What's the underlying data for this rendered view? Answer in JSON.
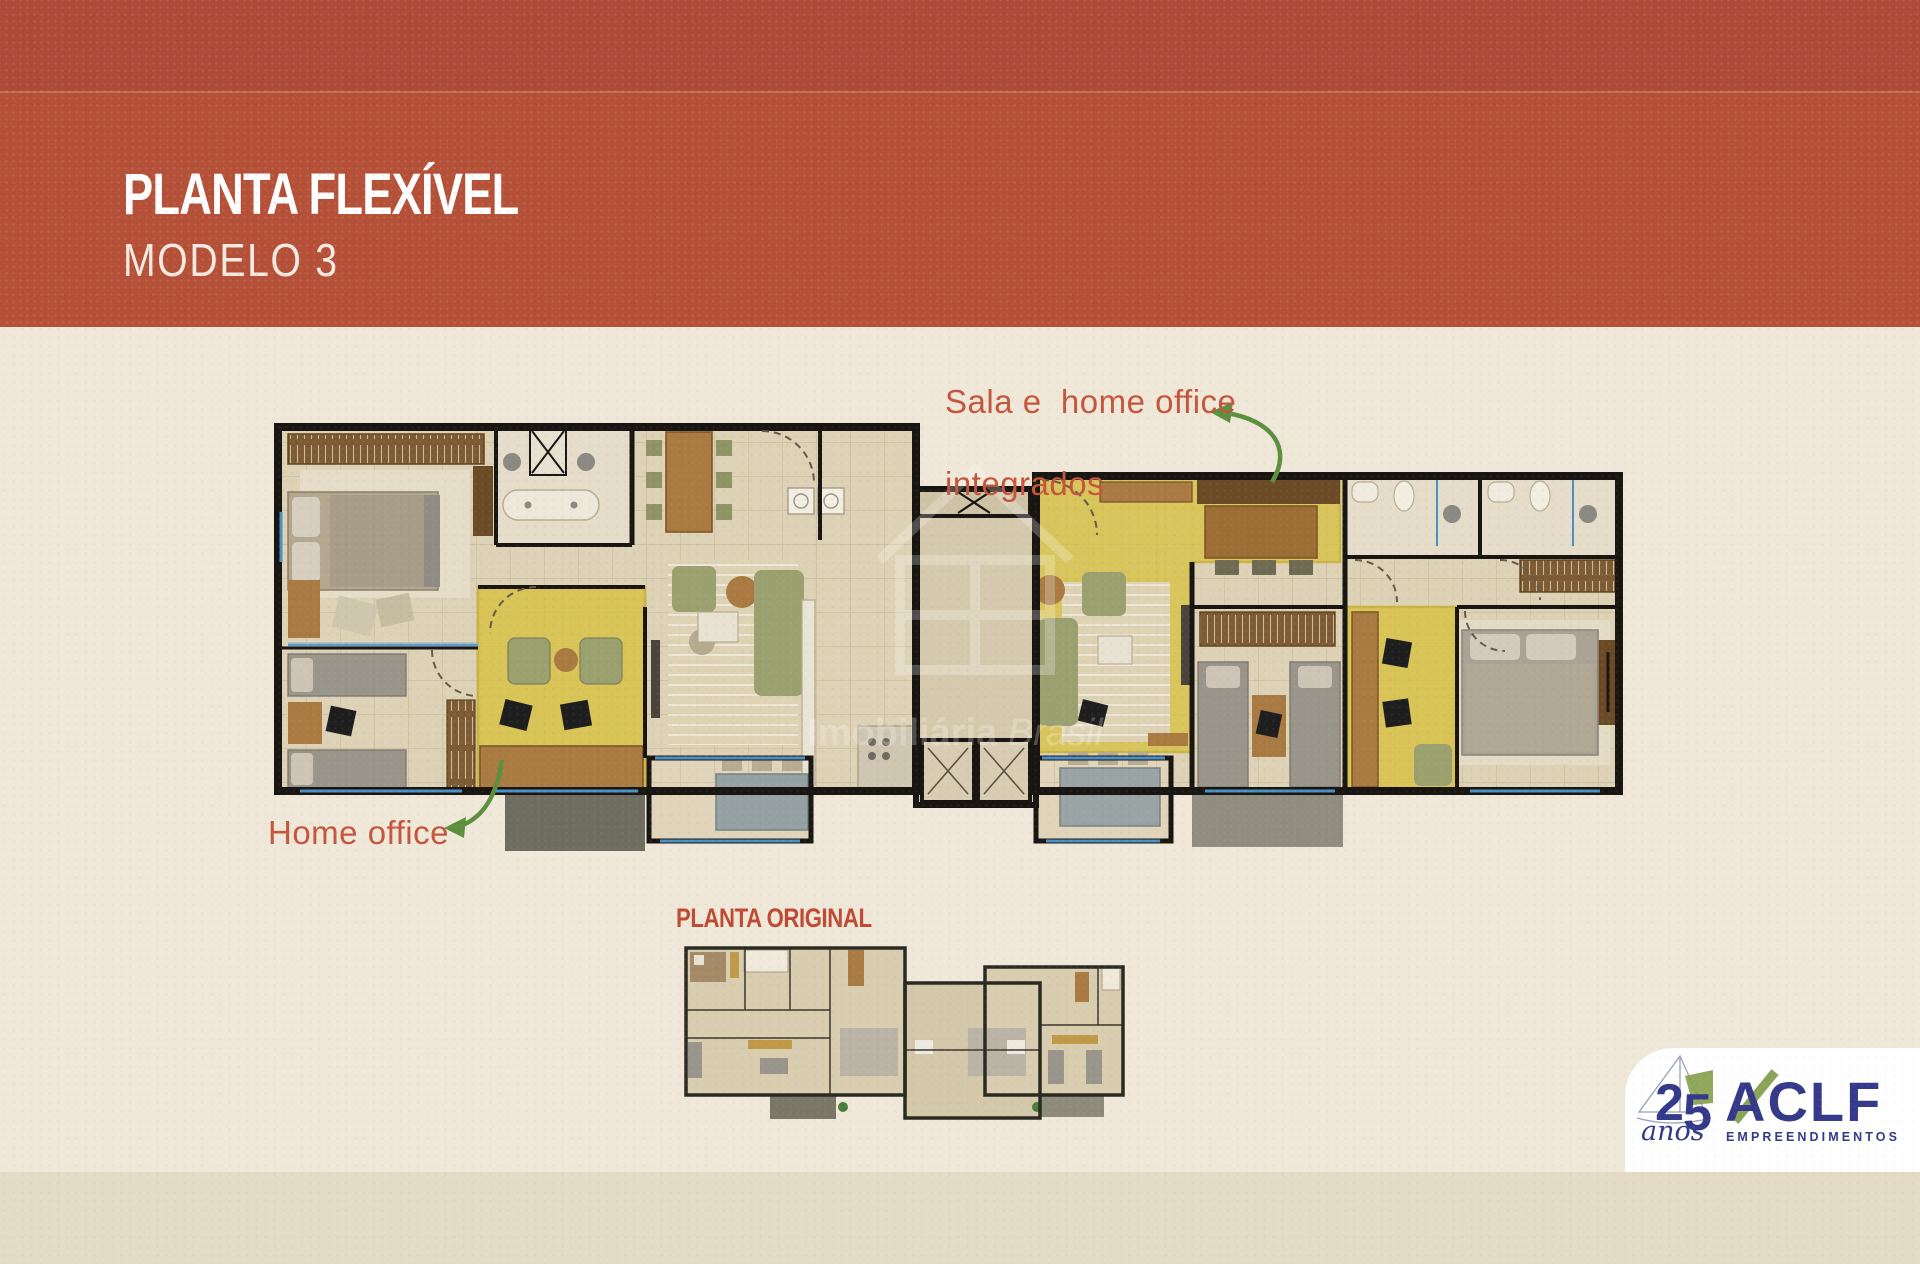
{
  "header": {
    "title": "PLANTA FLEXÍVEL",
    "subtitle": "MODELO 3"
  },
  "annotations": {
    "sala_line1": "Sala e  home office",
    "sala_line2": "integrados",
    "home_office": "Home office"
  },
  "original_plan": {
    "label": "PLANTA ORIGINAL"
  },
  "watermark": {
    "word1": "Imobiliária",
    "word2": " Brasil"
  },
  "logo": {
    "number_2": "2",
    "number_5": "5",
    "anos": "anos",
    "name": "ACLF",
    "tagline": "EMPREENDIMENTOS"
  },
  "colors": {
    "header_top": "#ad4b38",
    "header_bottom": "#b55138",
    "body_background": "#efe8d8",
    "footer_strip": "#e3dbc6",
    "annotation_red": "#c4563e",
    "original_label_red": "#bf4a33",
    "highlight_yellow": "#d8c247",
    "arrow_green": "#5c8f3f",
    "logo_navy": "#35398a",
    "logo_green": "#87a14e",
    "wall_black": "#181512",
    "floor_beige": "#ddd2b5"
  }
}
